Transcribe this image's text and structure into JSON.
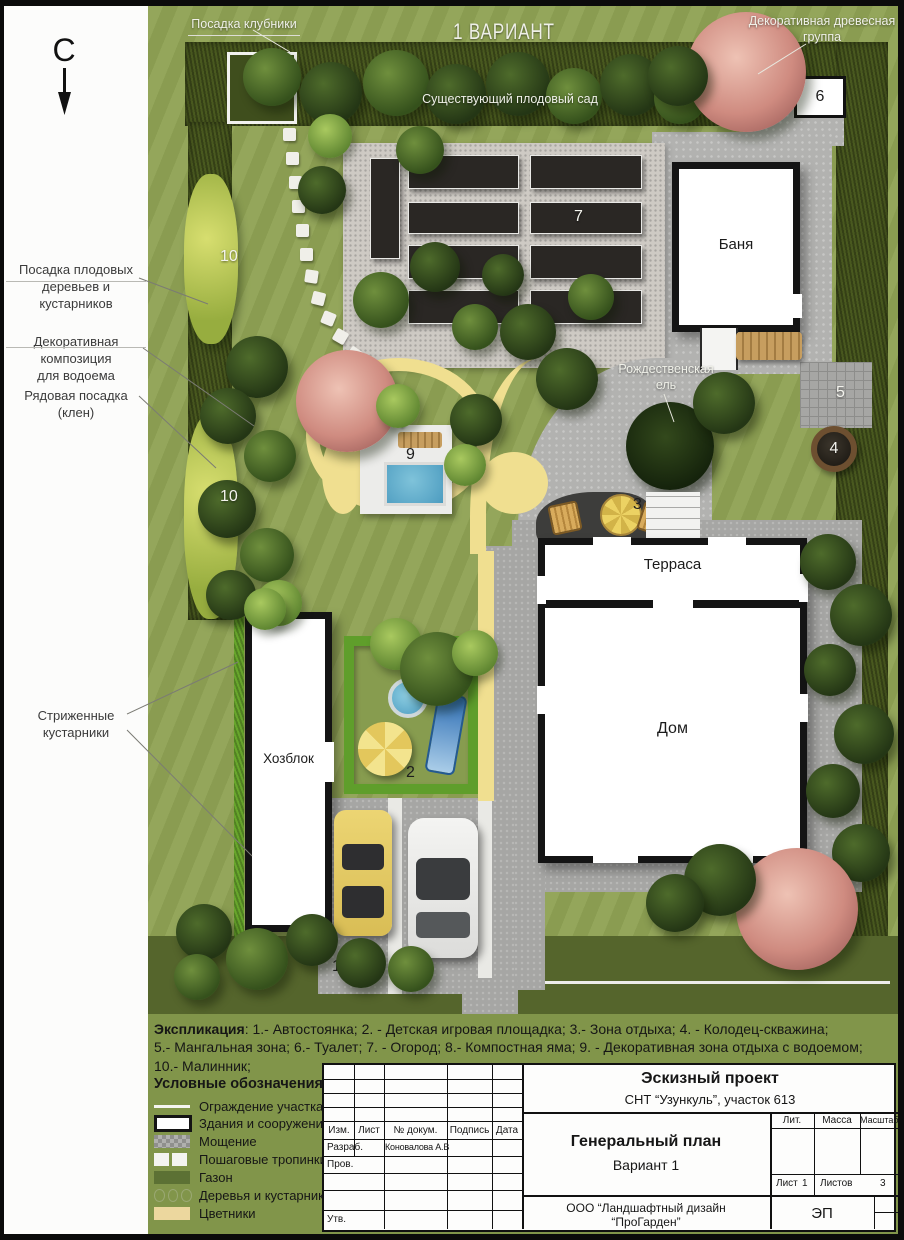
{
  "north": "С",
  "variant_title": "1 ВАРИАНТ",
  "plan_labels": {
    "strawberry": "Посадка клубники",
    "tree_group_line1": "Декоративная древесная",
    "tree_group_line2": "группа",
    "orchard": "Существующий плодовый сад",
    "spruce_line1": "Рождественская",
    "spruce_line2": "ель"
  },
  "margin_labels": {
    "fruit_line1": "Посадка плодовых",
    "fruit_line2": "деревьев и кустарников",
    "pond_line1": "Декоративная композиция",
    "pond_line2": "для водоема",
    "maple": "Рядовая посадка (клен)",
    "hedge_line1": "Стриженные",
    "hedge_line2": "кустарники"
  },
  "buildings": {
    "banya": "Баня",
    "terrace": "Терраса",
    "house": "Дом",
    "hozblok": "Хозблок"
  },
  "markers": {
    "parking": "1",
    "playground": "2",
    "rest_zone": "3",
    "well": "4",
    "bbq": "5",
    "toilet": "6",
    "garden": "7",
    "compost": "8",
    "water_zone": "9",
    "raspberry_top": "10",
    "raspberry_bottom": "10"
  },
  "explication": {
    "heading": "Экспликация",
    "line1": ": 1.- Автостоянка; 2. - Детская игровая площадка; 3.- Зона отдыха; 4. - Колодец-скважина;",
    "line2": "5.- Мангальная зона; 6.- Туалет; 7. - Огород; 8.- Компостная яма; 9. - Декоративная зона отдыха с водоемом;",
    "line3": "10.- Малинник;"
  },
  "legend": {
    "title": "Условные обозначения",
    "items": [
      {
        "key": "fence",
        "label": "Ограждение участка"
      },
      {
        "key": "buildings",
        "label": "Здания и сооружения"
      },
      {
        "key": "paving",
        "label": "Мощение"
      },
      {
        "key": "stepping",
        "label": "Пошаговые тропинки"
      },
      {
        "key": "lawn",
        "label": "Газон"
      },
      {
        "key": "trees",
        "label": "Деревья и кустарники"
      },
      {
        "key": "flowers",
        "label": "Цветники"
      }
    ]
  },
  "title_block": {
    "project_type": "Эскизный проект",
    "project_object": "СНТ “Узункуль”, участок 613",
    "drawing_title": "Генеральный план",
    "variant": "Вариант 1",
    "company_line1": "ООО “Ландшафтный дизайн",
    "company_line2": "“ПроГарден”",
    "stage": "ЭП",
    "col_izm": "Изм.",
    "col_list": "Лист",
    "col_doc": "№ докум.",
    "col_sign": "Подпись",
    "col_date": "Дата",
    "row_razrab": "Разраб.",
    "razrab_name": "Коновалова А.В",
    "row_prov": "Пров.",
    "row_utv": "Утв.",
    "lit": "Лит.",
    "mass": "Масса",
    "scale": "Масштаб",
    "sheet_label": "Лист",
    "sheet_num": "1",
    "sheets_label": "Листов",
    "sheets_num": "3"
  },
  "colors": {
    "lawn": "#8fa254",
    "hedge": "#49591f",
    "bright_hedge": "#68a62c",
    "paving": "#b2b2b0",
    "flowerbed": "#f0df90",
    "water": "#5fb0cf",
    "frame": "#0b0b0b"
  }
}
